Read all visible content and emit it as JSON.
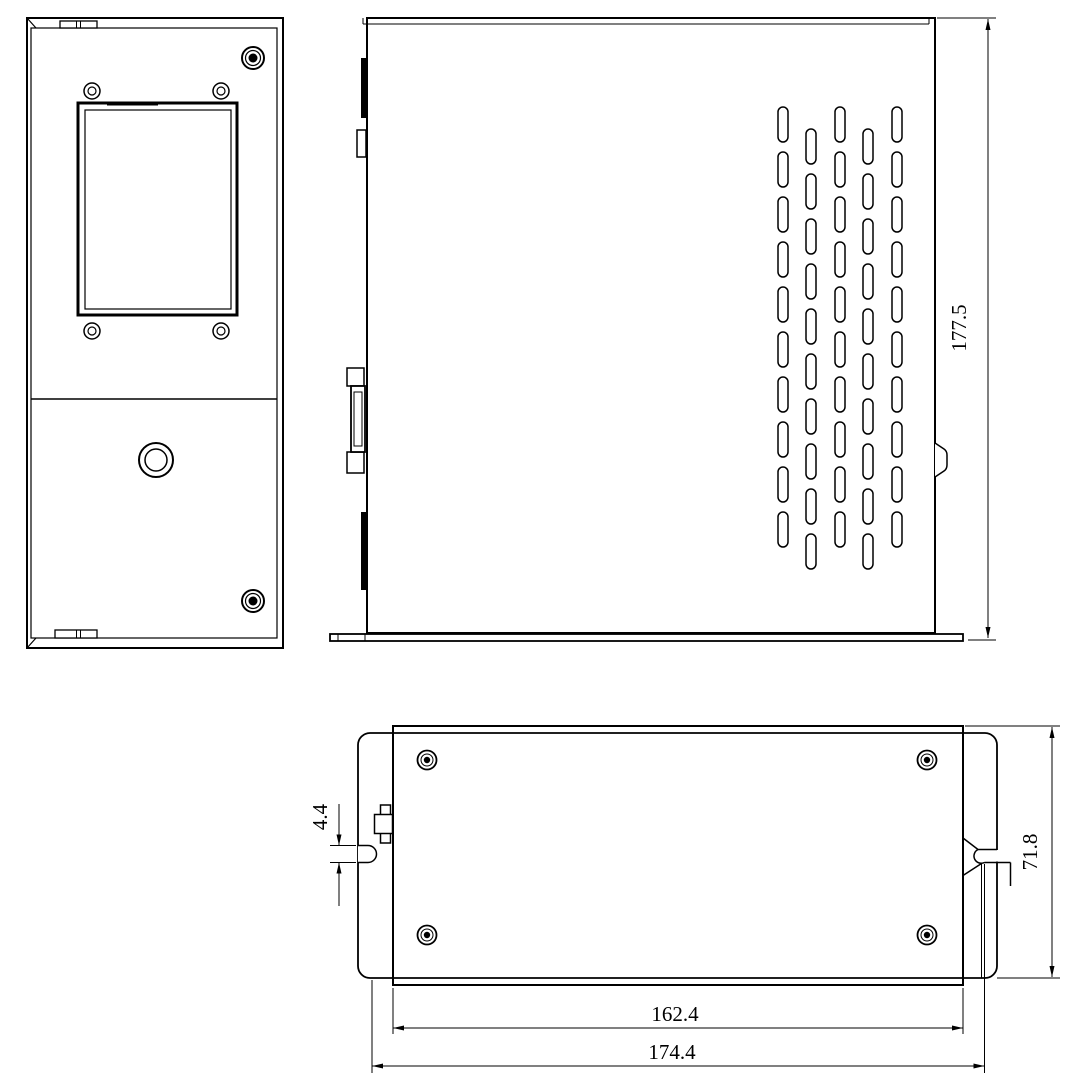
{
  "drawing": {
    "background": "#ffffff",
    "line_color": "#000000",
    "dimensions": {
      "side_height": "177.5",
      "flange_height": "71.8",
      "body_width": "162.4",
      "overall_width": "174.4",
      "slot_height": "4.4"
    }
  }
}
